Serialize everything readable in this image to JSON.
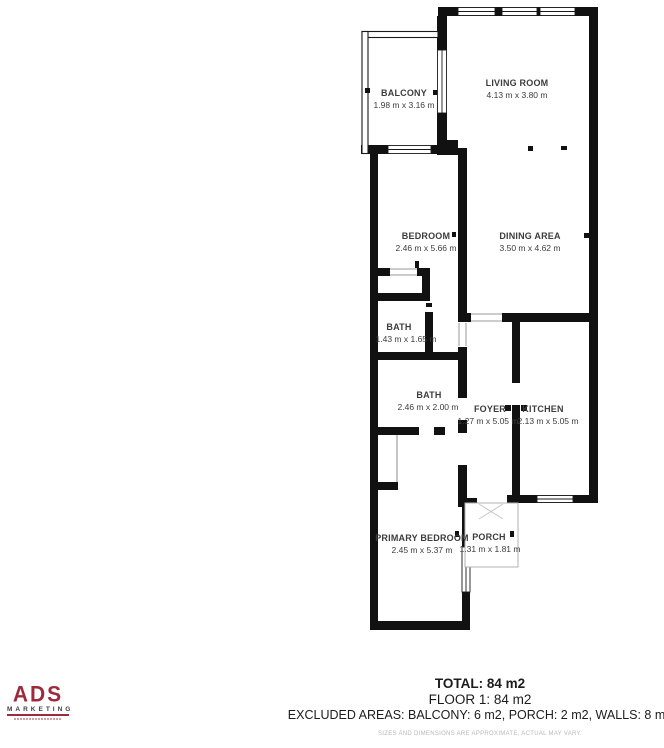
{
  "floorplan": {
    "rooms": [
      {
        "name": "BALCONY",
        "dims": "1.98 m x 3.16 m"
      },
      {
        "name": "LIVING ROOM",
        "dims": "4.13 m x 3.80 m"
      },
      {
        "name": "BEDROOM",
        "dims": "2.46 m x 5.66 m"
      },
      {
        "name": "DINING AREA",
        "dims": "3.50 m x 4.62 m"
      },
      {
        "name": "BATH",
        "dims": "1.43 m x 1.65 m"
      },
      {
        "name": "BATH",
        "dims": "2.46 m x 2.00 m"
      },
      {
        "name": "FOYER",
        "dims": "1.27 m x 5.05 m"
      },
      {
        "name": "KITCHEN",
        "dims": "2.13 m x 5.05 m"
      },
      {
        "name": "PRIMARY BEDROOM",
        "dims": "2.45 m x 5.37 m"
      },
      {
        "name": "PORCH",
        "dims": "1.31 m x 1.81 m"
      }
    ],
    "wall_color": "#111111"
  },
  "summary": {
    "total": "TOTAL: 84 m2",
    "floor": "FLOOR 1: 84 m2",
    "excluded": "EXCLUDED AREAS: BALCONY: 6 m2, PORCH: 2 m2, WALLS: 8 m2",
    "disclaimer": "SIZES AND DIMENSIONS ARE APPROXIMATE, ACTUAL MAY VARY."
  },
  "logo": {
    "name": "ADS",
    "subtitle": "MARKETING",
    "accent_color": "#9e2b3a"
  }
}
